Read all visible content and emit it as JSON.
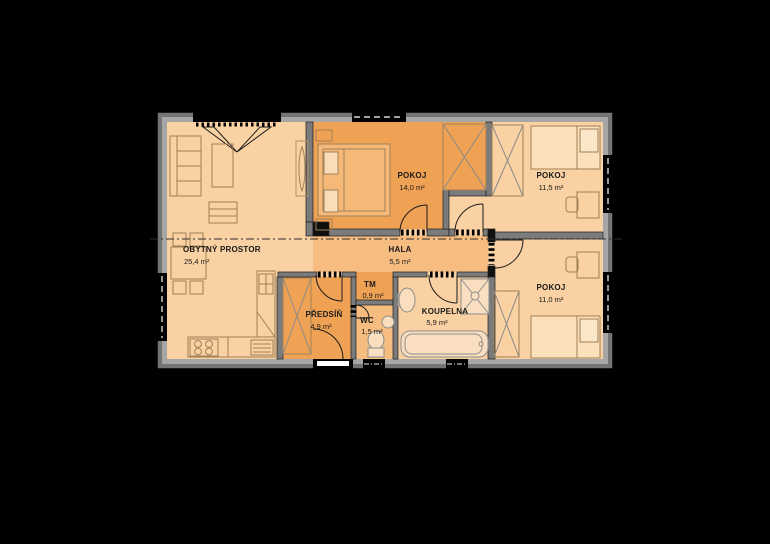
{
  "plan": {
    "title": "apartment-floor-plan",
    "rooms": [
      {
        "id": "obytny-prostor",
        "label": "OBYTNÝ PROSTOR",
        "area": "25,4 m²"
      },
      {
        "id": "pokoj-14",
        "label": "POKOJ",
        "area": "14,0 m²"
      },
      {
        "id": "pokoj-11-5",
        "label": "POKOJ",
        "area": "11,5 m²"
      },
      {
        "id": "pokoj-11-0",
        "label": "POKOJ",
        "area": "11,0 m²"
      },
      {
        "id": "hala",
        "label": "HALA",
        "area": "5,5 m²"
      },
      {
        "id": "tm",
        "label": "TM",
        "area": "0,9 m²"
      },
      {
        "id": "predsin",
        "label": "PŘEDSÍŇ",
        "area": "4,9 m²"
      },
      {
        "id": "wc",
        "label": "WC",
        "area": "1,5 m²"
      },
      {
        "id": "koupelna",
        "label": "KOUPELNA",
        "area": "5,9 m²"
      }
    ],
    "colors": {
      "background": "#000000",
      "room_light": "#f9d1a2",
      "room_medium": "#f6bc80",
      "room_dark": "#f0a254",
      "wall_outer": "#747474",
      "wall_inner_band": "#a6a6a6",
      "interior_wall": "#7b7b7b",
      "furniture_line": "#a08057",
      "fixture_fill": "#f9dfc0",
      "door_leaf_white": "#ffffff"
    }
  }
}
